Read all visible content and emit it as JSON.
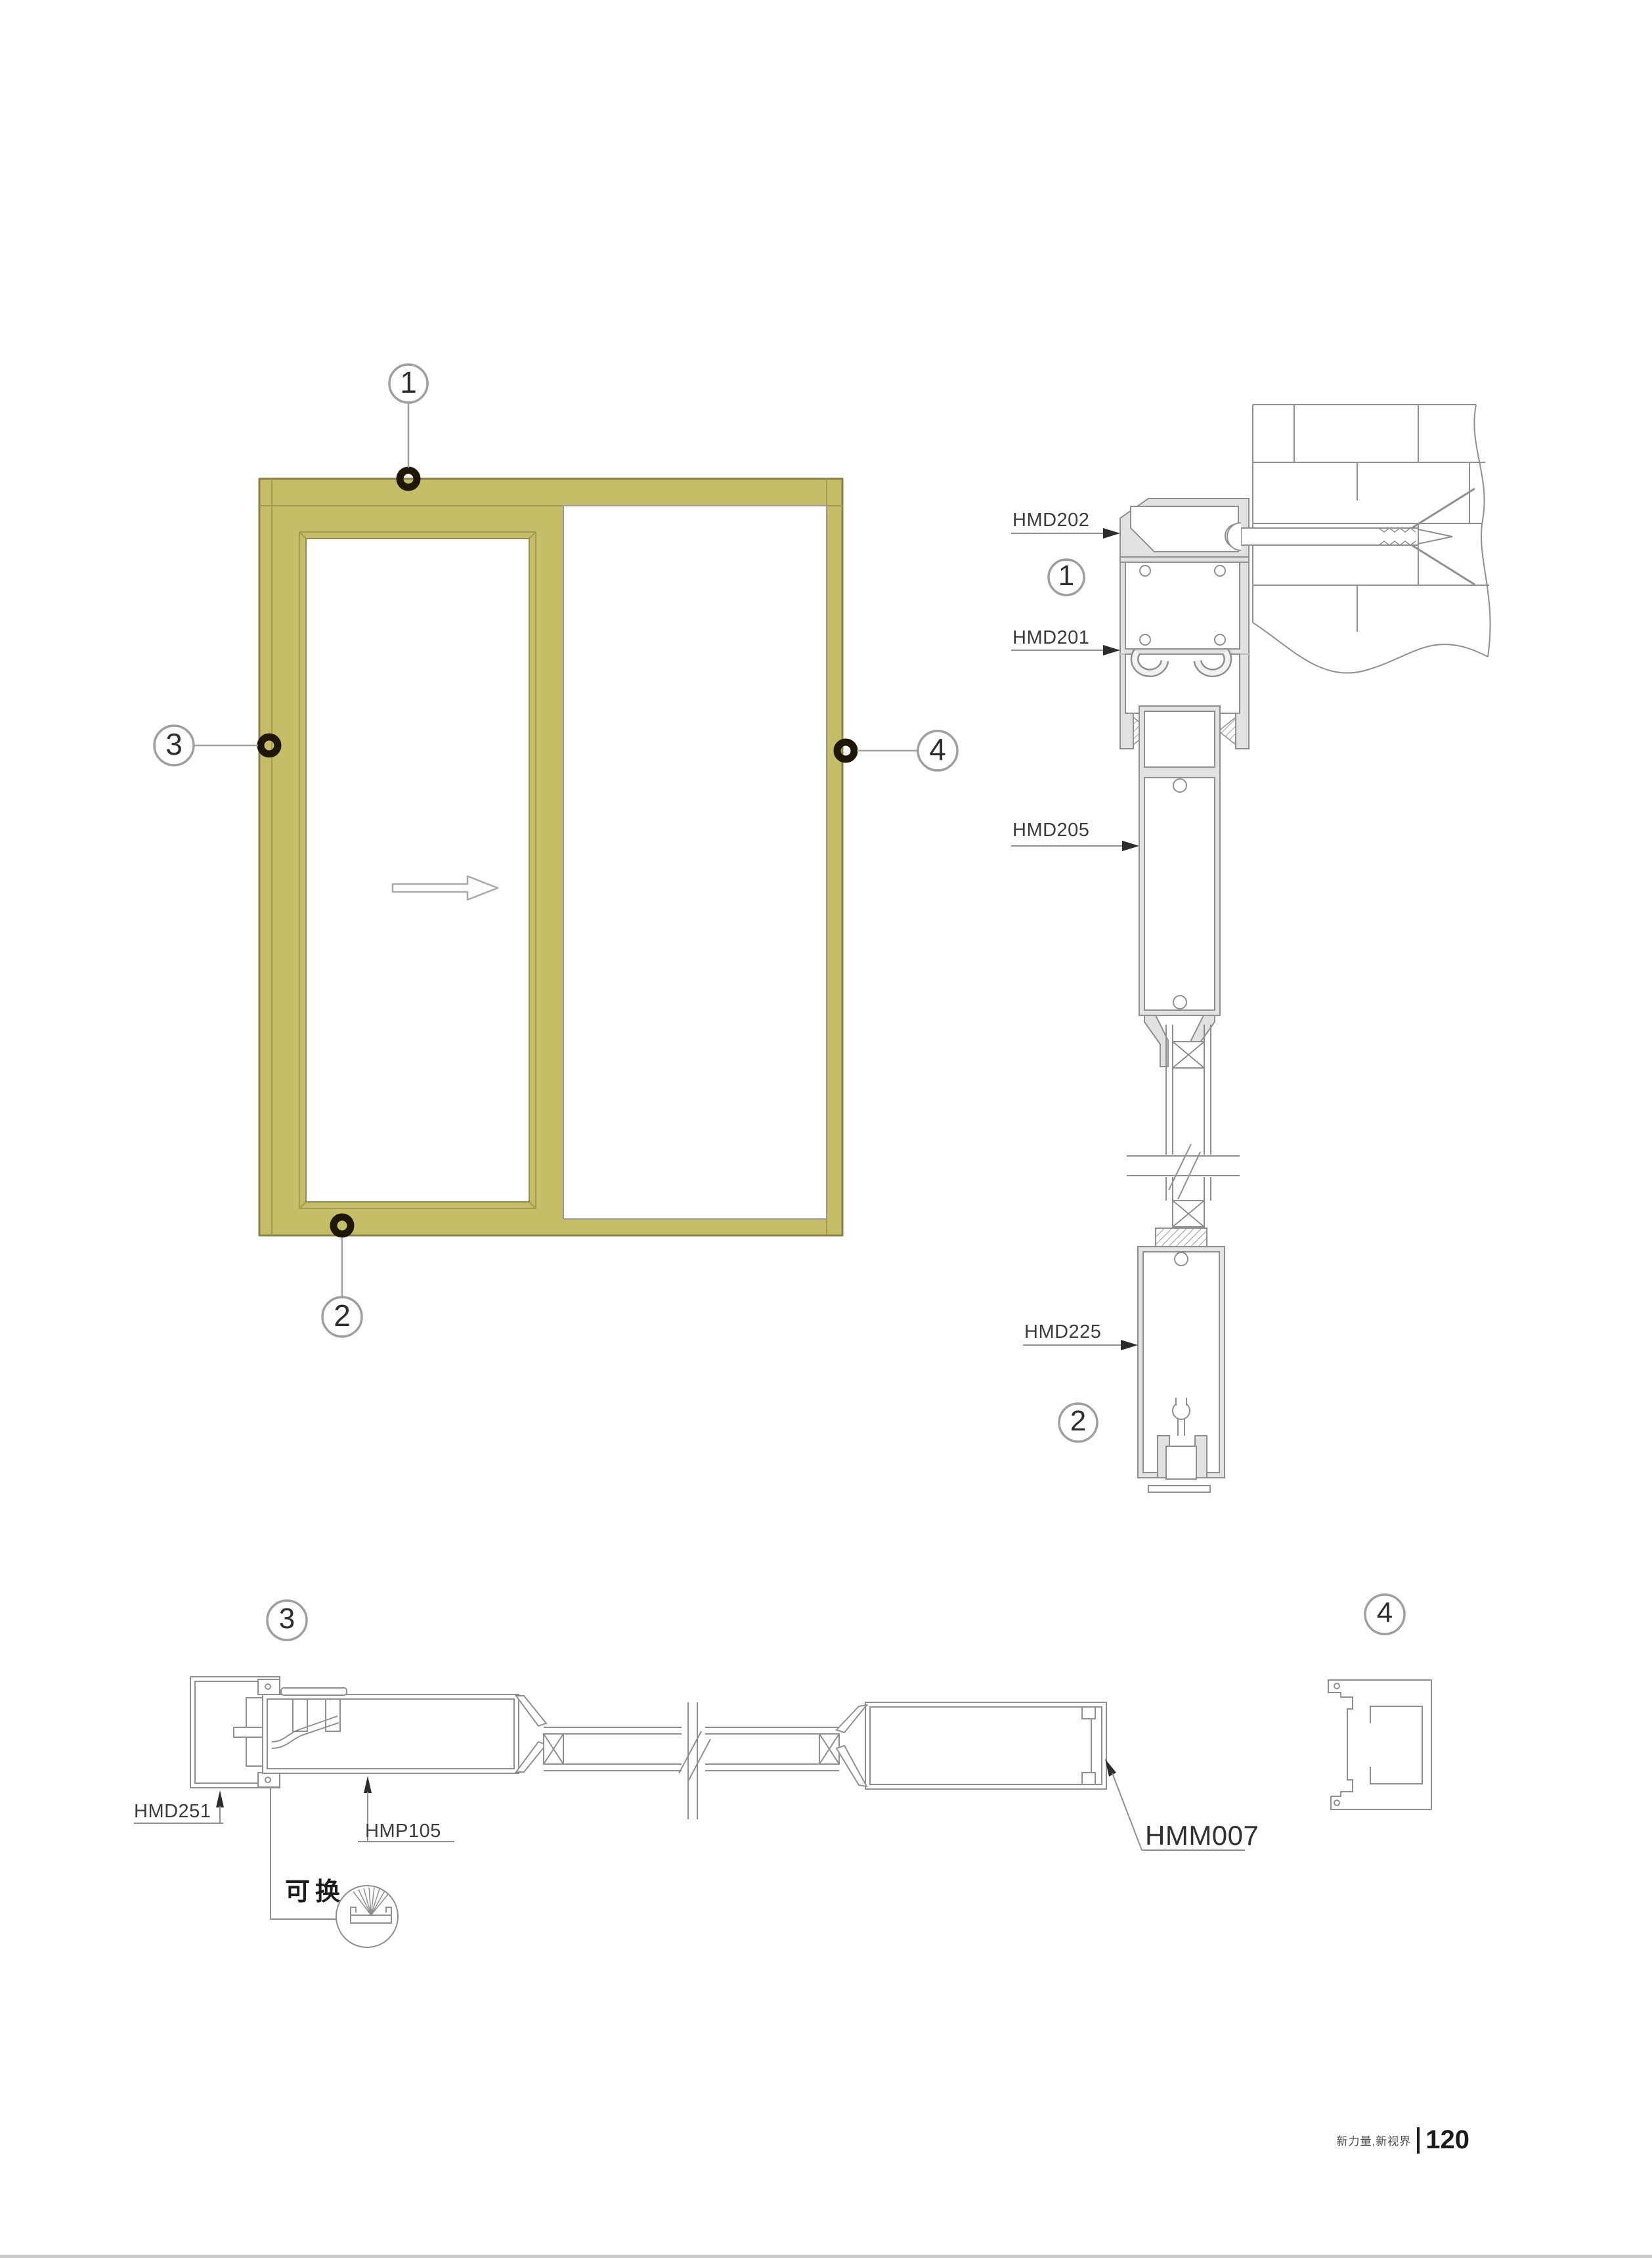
{
  "colors": {
    "frame_olive": "#c6bd69",
    "frame_olive_line": "#a49b52",
    "frame_border": "#8a8148",
    "drawing_line": "#8f8f8f",
    "profile_fill": "#e2e2e2",
    "marker_black": "#1f1708",
    "label_text": "#3b3b3b"
  },
  "elevation": {
    "callouts": [
      {
        "n": "1"
      },
      {
        "n": "2"
      },
      {
        "n": "3"
      },
      {
        "n": "4"
      }
    ]
  },
  "vertical_section": {
    "labels": [
      {
        "code": "HMD202"
      },
      {
        "code": "HMD201"
      },
      {
        "code": "HMD205"
      },
      {
        "code": "HMD225"
      }
    ],
    "callouts": [
      {
        "n": "1"
      },
      {
        "n": "2"
      }
    ]
  },
  "horizontal_section": {
    "labels": [
      {
        "code": "HMD251"
      },
      {
        "code": "HMP105"
      },
      {
        "code": "HMM007"
      }
    ],
    "callouts": [
      {
        "n": "3"
      },
      {
        "n": "4"
      }
    ],
    "replaceable_note": "可换"
  },
  "footer": {
    "brand": "新力量,新视界",
    "page": "120"
  }
}
